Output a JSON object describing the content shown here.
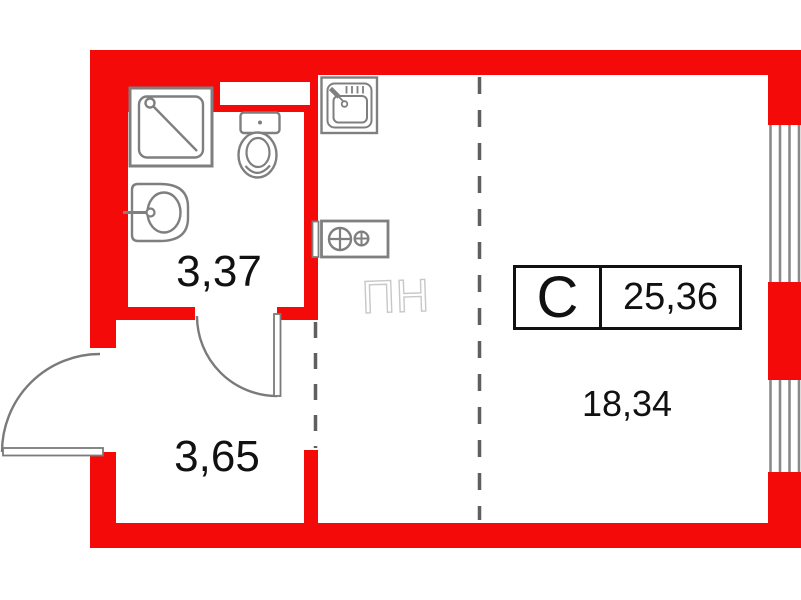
{
  "unit": {
    "type_code": "C",
    "total_area": "25,36"
  },
  "rooms": {
    "bathroom_area": "3,37",
    "hallway_area": "3,65",
    "living_kitchen_area": "18,34"
  },
  "appliance_ghost_label": "ПН",
  "colors": {
    "wall": "#f50a0a",
    "fixture_outline": "#7f7f7f",
    "door_outline": "#7a7a7a",
    "zone_dash": "#5f5f5f",
    "window_glazing": "#8a8a8a",
    "ghost_outline": "#c8c8c8",
    "text": "#111111"
  },
  "icons": {
    "fixtures": [
      "shower-icon",
      "washbasin-icon",
      "toilet-icon",
      "kitchen-sink-icon",
      "stove-icon",
      "appliance-ghost-icon",
      "window-icon",
      "door-arc-icon"
    ]
  }
}
